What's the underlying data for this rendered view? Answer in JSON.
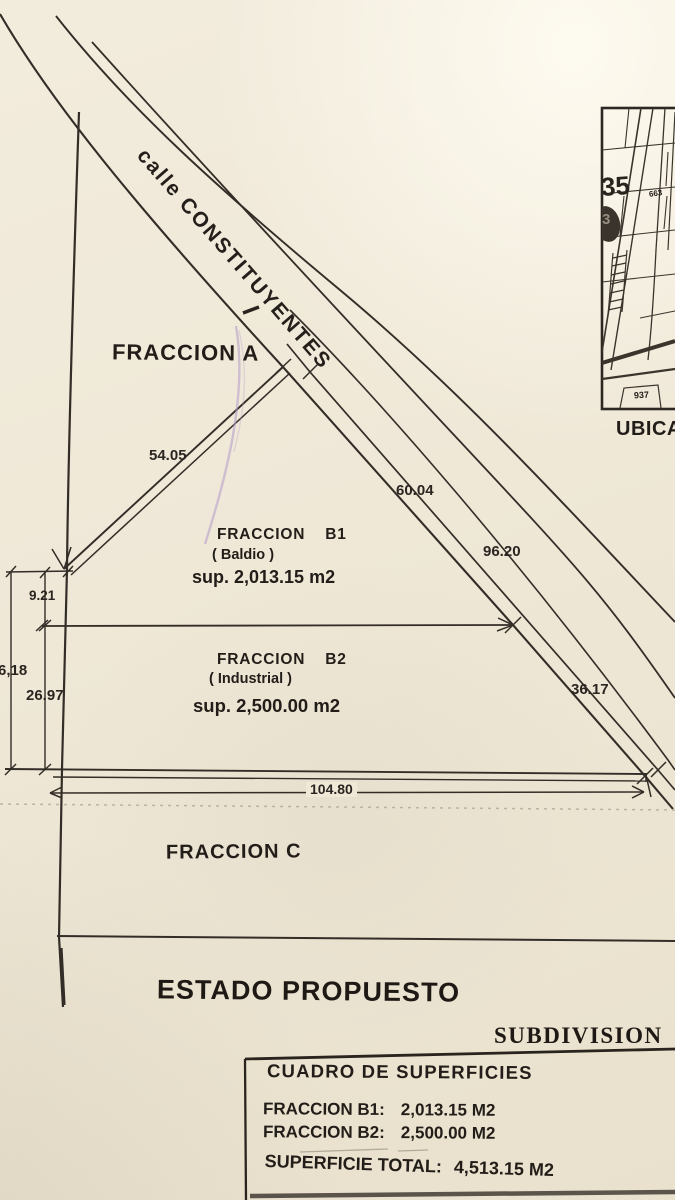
{
  "plan": {
    "street_name": "calle CONSTITUYENTES",
    "fraccion_a_label": "FRACCION A",
    "fraccion_b1": {
      "name": "FRACCION",
      "id": "B1",
      "use": "( Baldio )",
      "area": "sup. 2,013.15 m2"
    },
    "fraccion_b2": {
      "name": "FRACCION",
      "id": "B2",
      "use": "( Industrial )",
      "area": "sup. 2,500.00 m2"
    },
    "fraccion_c_label": "FRACCION C",
    "dims": {
      "nw_edge": "54.05",
      "b1_street": "60.04",
      "street_total": "96.20",
      "b2_street": "36.17",
      "south_edge": "104.80",
      "west_b1": "9.21",
      "west_total": "6,18",
      "west_b2": "26.97"
    }
  },
  "inset": {
    "caption": "UBICACION",
    "block_number": "35",
    "lot_number_top": "663",
    "lot_number_bottom": "937",
    "blob_digit": "3"
  },
  "titles": {
    "main": "ESTADO PROPUESTO",
    "sub": "SUBDIVISION"
  },
  "surfaces_table": {
    "title": "CUADRO DE SUPERFICIES",
    "rows": [
      {
        "label": "FRACCION B1:",
        "value": "2,013.15 M2"
      },
      {
        "label": "FRACCION B2:",
        "value": "2,500.00 M2"
      }
    ],
    "total_label": "SUPERFICIE TOTAL:",
    "total_value": "4,513.15 M2"
  }
}
